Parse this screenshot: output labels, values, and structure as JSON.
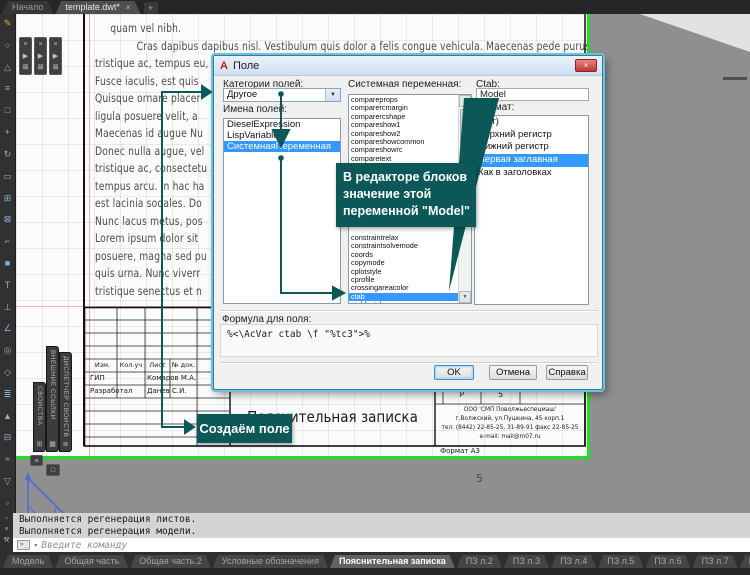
{
  "app": {
    "file_tabs": [
      {
        "label": "Начало",
        "active": false
      },
      {
        "label": "template.dwt*",
        "active": true
      }
    ]
  },
  "glyphs": {
    "close": "×",
    "new_tab": "+",
    "dropdown_arrow": "▼",
    "scroll_up": "▲",
    "scroll_down": "▼",
    "play": "▶",
    "pin": "⊠",
    "dot": "▫",
    "wrench": "⚒",
    "prompt_icon": ">_",
    "prompt_chevron": "▾",
    "palette_btn1": "≡",
    "palette_btn2": "□"
  },
  "toolbar": {
    "icons": [
      {
        "name": "pencil-icon",
        "glyph": "✎",
        "color": "#d8b44a"
      },
      {
        "name": "circle-icon",
        "glyph": "○"
      },
      {
        "name": "triangle-icon",
        "glyph": "△"
      },
      {
        "name": "lines-icon",
        "glyph": "≡"
      },
      {
        "name": "square-outline-icon",
        "glyph": "□"
      },
      {
        "name": "move-icon",
        "glyph": "+"
      },
      {
        "name": "rotate-icon",
        "glyph": "↻"
      },
      {
        "name": "rectangle-icon",
        "glyph": "▭"
      },
      {
        "name": "grid-plus-icon",
        "glyph": "⊞"
      },
      {
        "name": "boxed-x-icon",
        "glyph": "⊠"
      },
      {
        "name": "corner-icon",
        "glyph": "⌐"
      },
      {
        "name": "filled-square-icon",
        "glyph": "■"
      },
      {
        "name": "text-icon",
        "glyph": "T"
      },
      {
        "name": "perpendicular-icon",
        "glyph": "⊥"
      },
      {
        "name": "angle-icon",
        "glyph": "∠"
      },
      {
        "name": "target-icon",
        "glyph": "◎"
      },
      {
        "name": "diamond-icon",
        "glyph": "◇"
      },
      {
        "name": "equal-lines-icon",
        "glyph": "≣"
      },
      {
        "name": "up-triangle-icon",
        "glyph": "▲"
      },
      {
        "name": "boxed-minus-icon",
        "glyph": "⊟"
      },
      {
        "name": "wave-icon",
        "glyph": "≈"
      },
      {
        "name": "down-triangle-icon",
        "glyph": "▽"
      },
      {
        "name": "dot-icon",
        "glyph": "▫"
      }
    ]
  },
  "side_tabs": [
    {
      "label": "СВОЙСТВА",
      "icon_glyph": "⊞"
    },
    {
      "label": "ВНЕШНИЕ ССЫЛКИ",
      "icon_glyph": "▦"
    },
    {
      "label": "ДИСПЕТЧЕР СВОЙСТВ СЛОЁВ",
      "icon_glyph": "≣"
    }
  ],
  "drawing": {
    "paragraph_lines": [
      {
        "label": "quam vel nibh.",
        "indent": 19
      },
      {
        "label": "Cras dapibus dapibus nisl. Vestibulum quis dolor a felis congue vehicula. Maecenas pede purus",
        "indent": 52
      },
      "tristique ac, tempus eu,",
      "Fusce iaculis, est quis",
      "Quisque ornare placer",
      "ligula posuere velit, a",
      "Maecenas id augue Nu",
      "Donec nulla augue, vel",
      "tristique ac, consectetu",
      "tempus arcu. In hac ha",
      "est lacinia sodales. Do",
      "Nunc lacus metus, pos",
      "Lorem ipsum dolor sit",
      "posuere, magna sed pu",
      "quis urna. Nunc viverr",
      "tristique senectus et n"
    ],
    "title_block": {
      "header_cells": [
        "Изм.",
        "Кол.уч",
        "Лист",
        "№ док."
      ],
      "rows": [
        {
          "role": "ГИП",
          "name": "Комаров М.А."
        },
        {
          "role": "Разработал",
          "name": "Данев С.И."
        }
      ],
      "doc_title": "Пояснительная записка",
      "stage": "Р",
      "sheet_no": "5",
      "company_lines": [
        "ООО 'СМП Поволжьеспецмаш'",
        "г.Волжский, ул.Пушкина, 45 корп.1",
        "тел. (8442) 22-85-25, 31-89-91 факс 22-85-25",
        "e-mail: mail@m07.ru"
      ],
      "format_note": "Формат А3"
    },
    "page_number": "5"
  },
  "dialog": {
    "title": "Поле",
    "logo": "A",
    "category_label": "Категории полей:",
    "category_value": "Другое",
    "names_label": "Имена полей:",
    "name_items": [
      "DieselExpression",
      "LispVariable",
      {
        "label": "СистемнаяПеременная",
        "selected": true
      }
    ],
    "sysvar_label": "Системная переменная:",
    "sysvar_top_items": [
      "compareprops",
      "comparercmargin",
      "comparercshape",
      "compareshow1",
      "compareshow2",
      "compareshowcommon",
      "compareshowrc",
      "comparetext",
      "comparetolerance"
    ],
    "sysvar_bottom_items": [
      "constraintrelax",
      "constraintsolvemode",
      "coords",
      "copymode",
      "cplotstyle",
      "cprofile",
      "crossingareacolor",
      {
        "label": "ctab",
        "selected": true
      },
      "ctablestyle"
    ],
    "ctab_label": "Ctab:",
    "ctab_value": "Model",
    "format_label": "Формат:",
    "format_items": [
      "(нет)",
      "Верхний регистр",
      "Нижний регистр",
      {
        "label": "Первая заглавная",
        "selected": true
      },
      "Как в заголовках"
    ],
    "formula_label": "Формула для поля:",
    "formula_value": "%<\\AcVar ctab \\f \"%tc3\">%",
    "buttons": {
      "ok": "OK",
      "cancel": "Отмена",
      "help": "Справка"
    }
  },
  "annotations": {
    "tooltip_lines": [
      "В редакторе блоков",
      "значение этой",
      "переменной \"Model\""
    ],
    "callout": "Создаём поле",
    "accent_color": "#0c5858"
  },
  "command_panel": {
    "history": [
      "Выполняется регенерация листов.",
      "Выполняется регенерация модели."
    ],
    "prompt_placeholder": "Введите команду"
  },
  "layout_tabs": [
    "Модель",
    "Общая часть",
    "Общая часть.2",
    "Условные обозначения",
    {
      "label": "Пояснительная записка",
      "active": true
    },
    "ПЗ л.2",
    "ПЗ л.3",
    "ПЗ л.4",
    "ПЗ л.5",
    "ПЗ л.6",
    "ПЗ л.7",
    "ПЗ л.8",
    "ПЗ л.9",
    "ПЗ л.10",
    "ПЗ л.11"
  ],
  "colors": {
    "selection_blue": "#3399ff",
    "annotation_teal": "#0c5858",
    "viewport_green": "#22dd22",
    "canvas_grey": "#8f8f8f"
  }
}
